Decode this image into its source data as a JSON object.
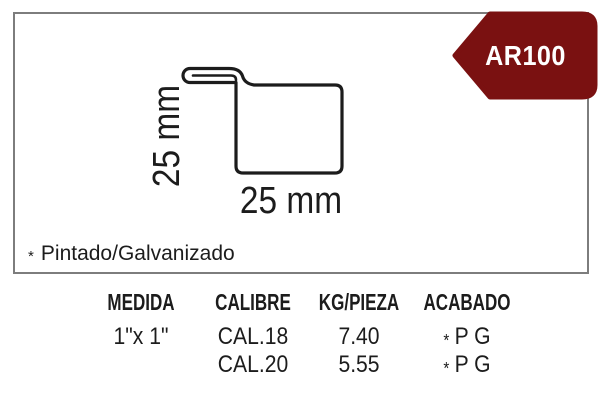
{
  "badge": {
    "label": "AR100"
  },
  "colors": {
    "badge_bg": "#7a1111",
    "badge_text": "#ffffff",
    "panel_border": "#7d7d7d",
    "ink": "#1c1c1c"
  },
  "diagram": {
    "height_label": "25 mm",
    "width_label": "25 mm"
  },
  "note": {
    "star": "*",
    "text": "Pintado/Galvanizado"
  },
  "table": {
    "columns": [
      {
        "header": "MEDIDA",
        "rows": [
          "1\"x 1\"",
          ""
        ]
      },
      {
        "header": "CALIBRE",
        "rows": [
          "CAL.18",
          "CAL.20"
        ]
      },
      {
        "header": "KG/PIEZA",
        "rows": [
          "7.40",
          "5.55"
        ]
      },
      {
        "header": "ACABADO",
        "rows": [
          {
            "star": "*",
            "text": "P G"
          },
          {
            "star": "*",
            "text": "P G"
          }
        ]
      }
    ]
  }
}
